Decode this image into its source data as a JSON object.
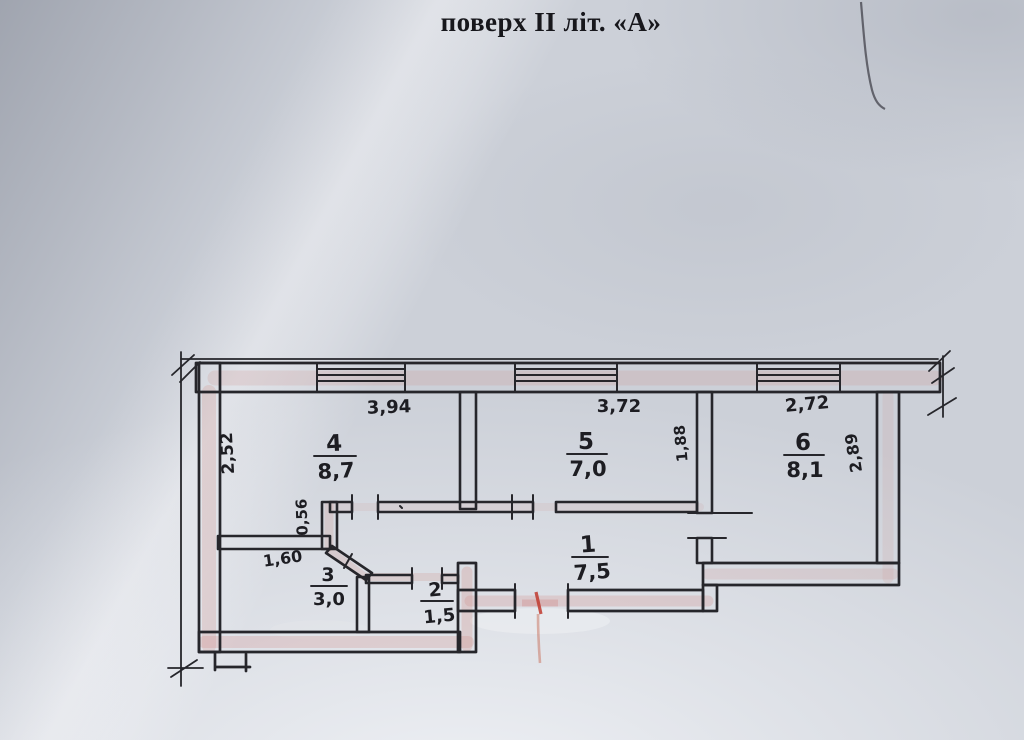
{
  "title": "поверх II  літ. «А»",
  "plan": {
    "rooms": [
      {
        "number": "1",
        "area": "7,5"
      },
      {
        "number": "2",
        "area": "1,5"
      },
      {
        "number": "3",
        "area": "3,0"
      },
      {
        "number": "4",
        "area": "8,7"
      },
      {
        "number": "5",
        "area": "7,0"
      },
      {
        "number": "6",
        "area": "8,1"
      }
    ],
    "dims": {
      "room4_width": "3,94",
      "room4_depth": "2,52",
      "room5_width": "3,72",
      "room5_depth": "1,88",
      "room6_width": "2,72",
      "room6_depth": "2,89",
      "niche_depth": "0,56",
      "room3_width": "1,60"
    },
    "colors": {
      "ink": "#26262b",
      "marker_pink": "#cf8d86",
      "marker_red": "#bf3a2e",
      "paper": "#ccd0d8"
    }
  }
}
